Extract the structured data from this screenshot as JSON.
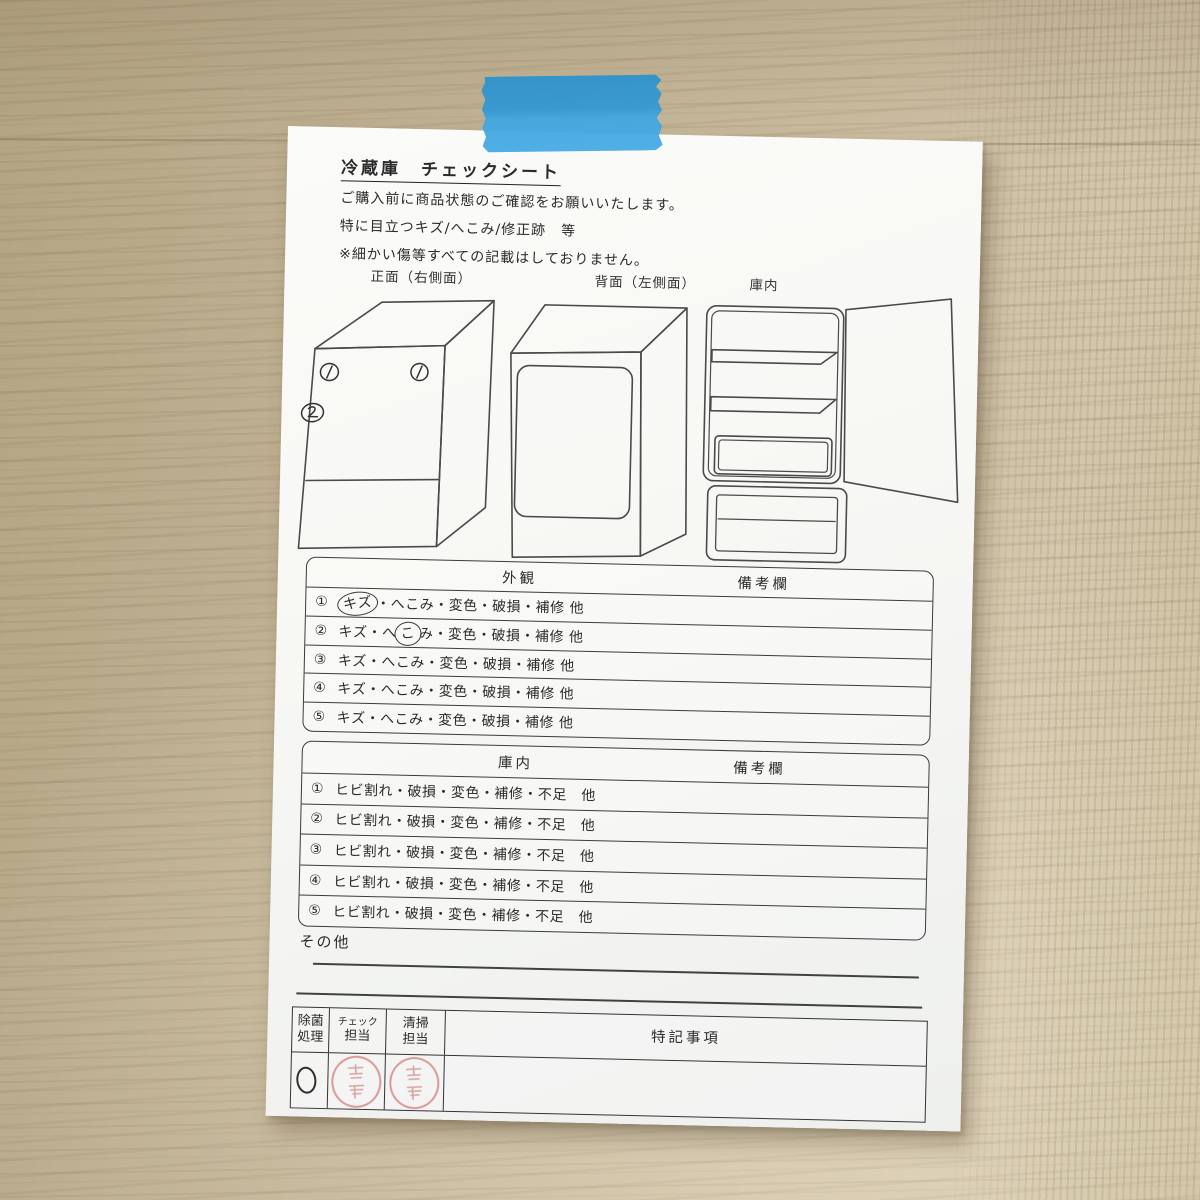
{
  "paper": {
    "title": "冷蔵庫　チェックシート",
    "intro": [
      "ご購入前に商品状態のご確認をお願いいたします。",
      "特に目立つキズ/へこみ/修正跡　等",
      "※細かい傷等すべての記載はしておりません。"
    ],
    "diagrams": {
      "front_label": "正面（右側面）",
      "back_label": "背面（左側面）",
      "interior_label": "庫内"
    },
    "marks": [
      {
        "n": "1"
      },
      {
        "n": "1"
      },
      {
        "n": "2"
      }
    ],
    "tables": [
      {
        "title": "外観",
        "remarks": "備考欄",
        "rows": [
          {
            "num": "①",
            "pre": "",
            "circ": "キズ",
            "post": "・へこみ・変色・破損・補修 他"
          },
          {
            "num": "②",
            "pre": "キズ・へ",
            "circ": "こ",
            "post": "み・変色・破損・補修 他"
          },
          {
            "num": "③",
            "pre": "キズ・へこみ・変色・破損・補修 他",
            "circ": "",
            "post": ""
          },
          {
            "num": "④",
            "pre": "キズ・へこみ・変色・破損・補修 他",
            "circ": "",
            "post": ""
          },
          {
            "num": "⑤",
            "pre": "キズ・へこみ・変色・破損・補修 他",
            "circ": "",
            "post": ""
          }
        ]
      },
      {
        "title": "庫内",
        "remarks": "備考欄",
        "rows": [
          {
            "num": "①",
            "pre": "ヒビ割れ・破損・変色・補修・不足　他",
            "circ": "",
            "post": ""
          },
          {
            "num": "②",
            "pre": "ヒビ割れ・破損・変色・補修・不足　他",
            "circ": "",
            "post": ""
          },
          {
            "num": "③",
            "pre": "ヒビ割れ・破損・変色・補修・不足　他",
            "circ": "",
            "post": ""
          },
          {
            "num": "④",
            "pre": "ヒビ割れ・破損・変色・補修・不足　他",
            "circ": "",
            "post": ""
          },
          {
            "num": "⑤",
            "pre": "ヒビ割れ・破損・変色・補修・不足　他",
            "circ": "",
            "post": ""
          }
        ]
      }
    ],
    "other_label": "その他",
    "staff": {
      "c1a": "除菌",
      "c1b": "処理",
      "c2a": "チェック",
      "c2b": "担当",
      "c3a": "清掃",
      "c3b": "担当",
      "c4": "特記事項",
      "jokin_mark": "○",
      "check_stamp": "red name stamp",
      "cleaning_stamp": "red name stamp"
    }
  },
  "tape": {
    "color": "#3a9fd8"
  }
}
